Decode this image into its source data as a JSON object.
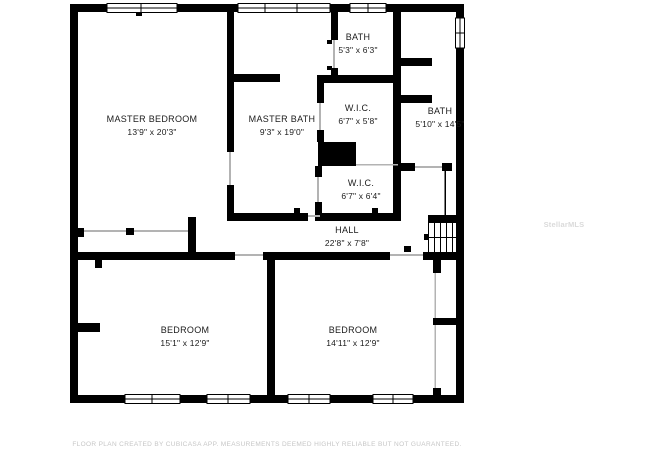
{
  "floor_plan": {
    "rooms": [
      {
        "name": "MASTER BEDROOM",
        "dims": "13'9\" x 20'3\""
      },
      {
        "name": "MASTER BATH",
        "dims": "9'3\" x 19'0\""
      },
      {
        "name": "BATH",
        "dims": "5'3\" x 6'3\""
      },
      {
        "name": "W.I.C.",
        "dims": "6'7\" x 5'8\""
      },
      {
        "name": "BATH",
        "dims": "5'10\" x 14'5\""
      },
      {
        "name": "W.I.C.",
        "dims": "6'7\" x 6'4\""
      },
      {
        "name": "HALL",
        "dims": "22'8\" x 7'8\""
      },
      {
        "name": "BEDROOM",
        "dims": "15'1\" x 12'9\""
      },
      {
        "name": "BEDROOM",
        "dims": "14'11\" x 12'9\""
      }
    ],
    "watermark": "StellarMLS",
    "footer": "FLOOR PLAN CREATED BY CUBICASA APP. MEASUREMENTS DEEMED HIGHLY RELIABLE BUT NOT GUARANTEED.",
    "colors": {
      "wall": "#000000",
      "background": "#ffffff",
      "label_text": "#1b1b1b",
      "watermark_text": "#dadada",
      "footer_text": "#c6c6c6"
    }
  }
}
